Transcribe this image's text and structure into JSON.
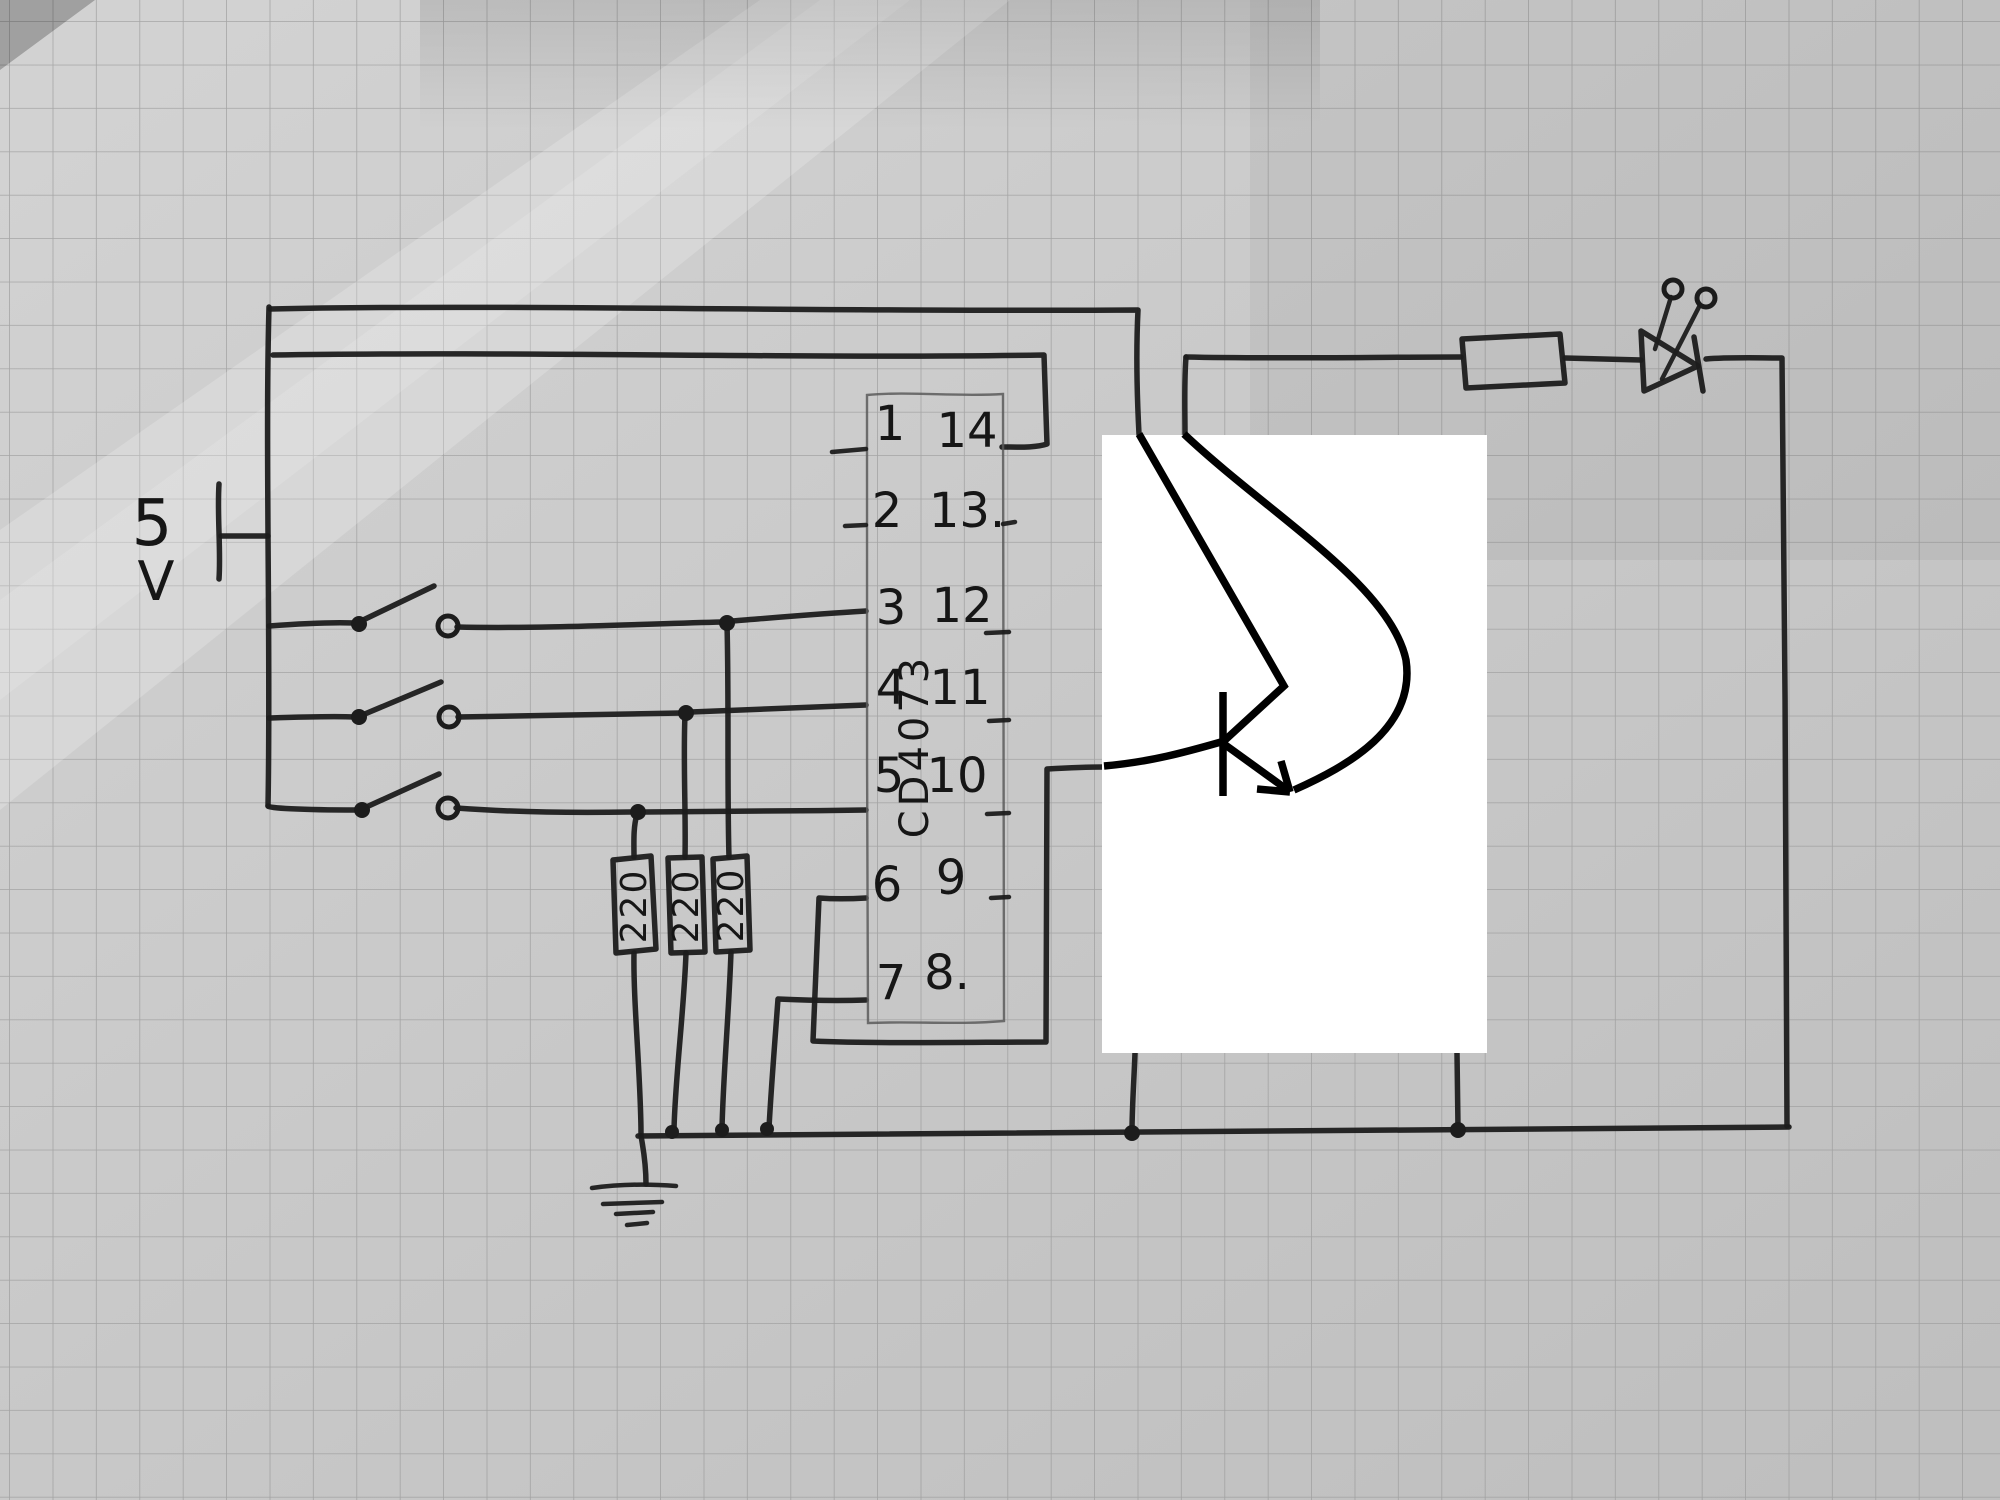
{
  "scene": {
    "description": "photo of a hand-drawn electronics schematic on squared graph paper",
    "overlay_note": "white patch with marker-drawn NPN transistor"
  },
  "power_supply": {
    "value": "5",
    "unit": "V"
  },
  "ic": {
    "name": "CD4073",
    "left_pins": [
      "1",
      "2",
      "3",
      "4",
      "5",
      "6",
      "7"
    ],
    "right_pins": [
      "14",
      "13.",
      "12",
      "11",
      "10",
      "9",
      "8."
    ]
  },
  "resistors": {
    "values": [
      "220",
      "220",
      "220"
    ]
  },
  "components": [
    "5V-supply",
    "toggle-switch-1",
    "toggle-switch-2",
    "toggle-switch-3",
    "resistor-220-1",
    "resistor-220-2",
    "resistor-220-3",
    "ic-cd4073",
    "ground-symbol",
    "ground-bus",
    "npn-transistor-marker-overlay",
    "series-resistor",
    "led"
  ],
  "colors": {
    "ink": "#1c1c1c",
    "marker_ink": "#000000",
    "paper": "#c8c8c8",
    "grid_line": "#979797",
    "patch": "#ffffff"
  }
}
